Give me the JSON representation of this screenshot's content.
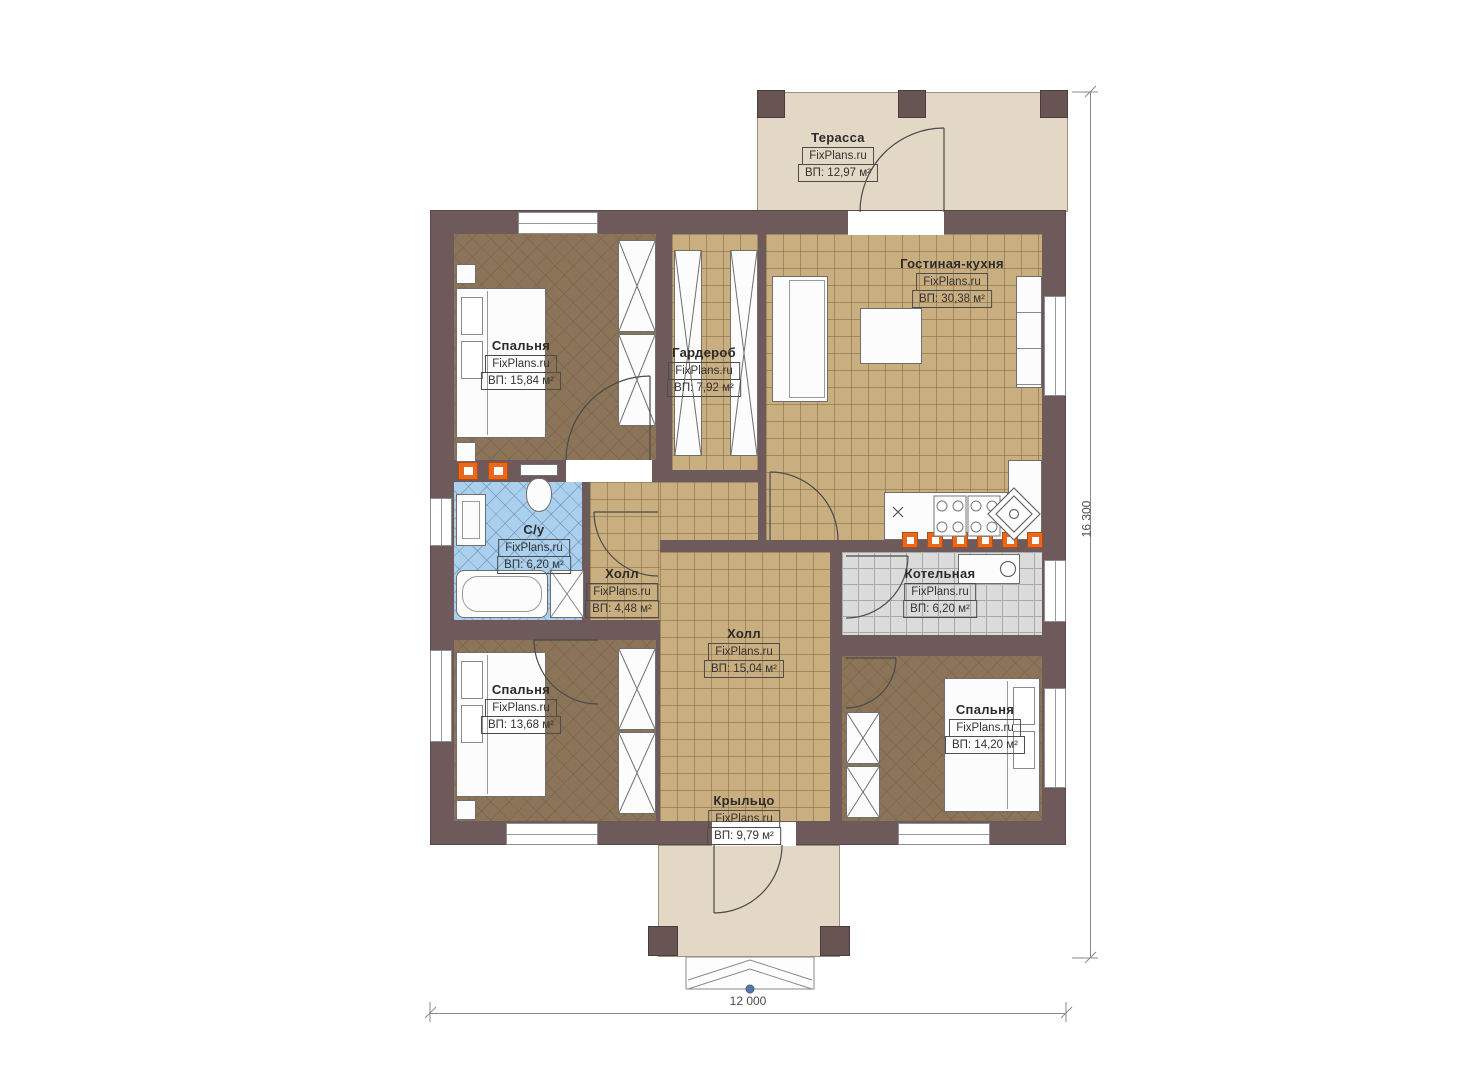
{
  "plan": {
    "brand": "FixPlans.ru",
    "rooms": [
      {
        "name": "Терасса",
        "brand": "FixPlans.ru",
        "area": "ВП: 12,97 м²"
      },
      {
        "name": "Гостиная-кухня",
        "brand": "FixPlans.ru",
        "area": "ВП: 30,38 м²"
      },
      {
        "name": "Спальня",
        "brand": "FixPlans.ru",
        "area": "ВП: 15,84 м²"
      },
      {
        "name": "Гардероб",
        "brand": "FixPlans.ru",
        "area": "ВП: 7,92 м²"
      },
      {
        "name": "С/у",
        "brand": "FixPlans.ru",
        "area": "ВП: 6,20 м²"
      },
      {
        "name": "Холл",
        "brand": "FixPlans.ru",
        "area": "ВП: 4,48 м²"
      },
      {
        "name": "Котельная",
        "brand": "FixPlans.ru",
        "area": "ВП: 6,20 м²"
      },
      {
        "name": "Холл",
        "brand": "FixPlans.ru",
        "area": "ВП: 15,04 м²"
      },
      {
        "name": "Спальня",
        "brand": "FixPlans.ru",
        "area": "ВП: 13,68 м²"
      },
      {
        "name": "Спальня",
        "brand": "FixPlans.ru",
        "area": "ВП: 14,20 м²"
      },
      {
        "name": "Крыльцо",
        "brand": "FixPlans.ru",
        "area": "ВП: 9,79 м²"
      }
    ],
    "dimensions": {
      "bottom": "12 000",
      "right": "16 300"
    },
    "colors": {
      "wall": "#6e5a5a",
      "floor_tan": "#c9ae80",
      "floor_brown": "#8b7457",
      "floor_tile_blue": "#abd0ee",
      "floor_tile_gray": "#dbdbdb",
      "terrace_beige": "#e3d8c6",
      "accent_orange": "#e8681c"
    }
  }
}
